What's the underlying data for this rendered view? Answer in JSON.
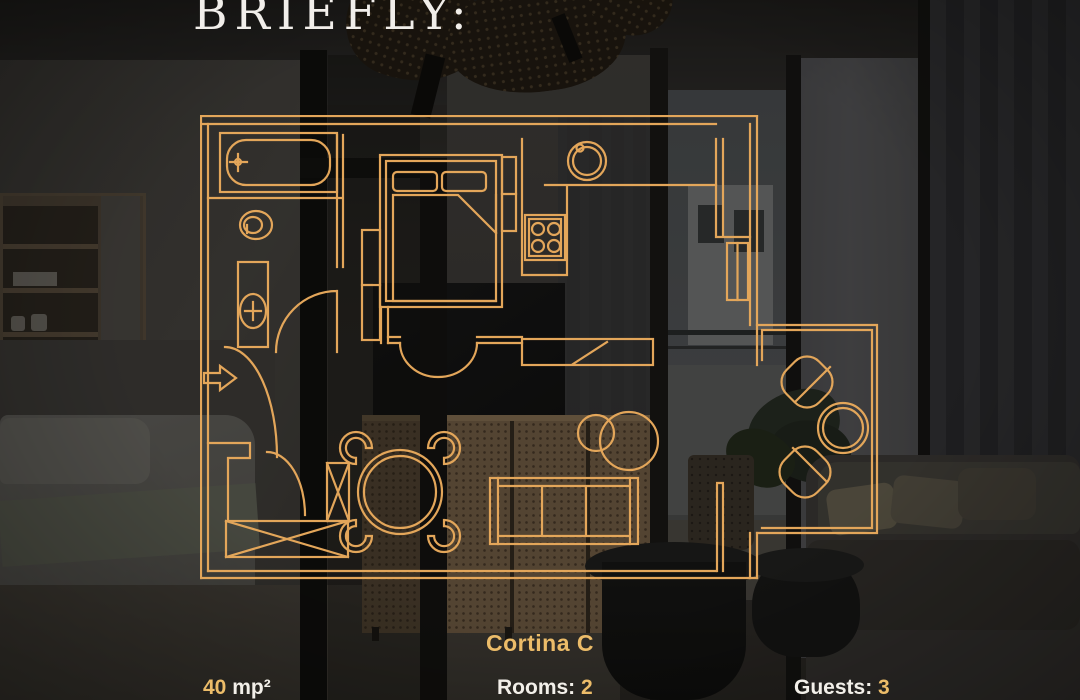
{
  "header": {
    "title": "BRIEFLY:"
  },
  "plan": {
    "name": "Cortina C",
    "line_color": "#E3A65A",
    "icons": [
      "bathtub-icon",
      "toilet-icon",
      "washbasin-icon",
      "bed-icon",
      "wardrobe-icon",
      "stove-icon",
      "kitchen-sink-icon",
      "dining-table-icon",
      "sofa-icon",
      "coffee-tables-icon",
      "tv-unit-icon",
      "balcony-armchairs-icon",
      "balcony-table-icon",
      "entry-arrow-icon",
      "door-swing-icon",
      "window-icon"
    ]
  },
  "stats": {
    "area": {
      "value": "40",
      "unit": " mp²"
    },
    "rooms": {
      "label": "Rooms: ",
      "value": "2"
    },
    "guests": {
      "label": "Guests: ",
      "value": "3"
    }
  },
  "colors": {
    "gold_text": "#ECBC69",
    "white_text": "#F2EFE9",
    "plan_line": "#E3A65A"
  }
}
